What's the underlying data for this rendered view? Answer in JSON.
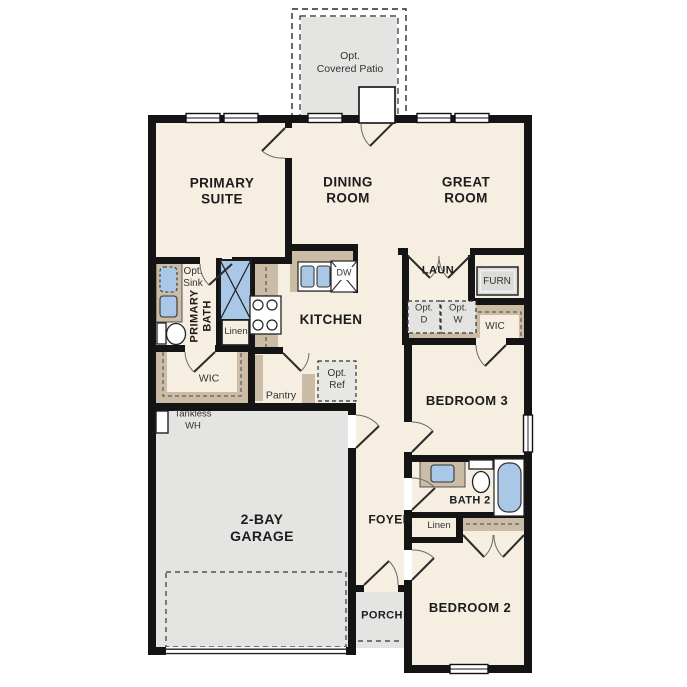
{
  "floorplan": {
    "rooms": {
      "opt_covered_patio": "Opt.\nCovered Patio",
      "primary_suite": "PRIMARY\nSUITE",
      "dining_room": "DINING\nROOM",
      "great_room": "GREAT\nROOM",
      "laundry": "LAUN",
      "kitchen": "KITCHEN",
      "primary_bath": "PRIMARY\nBATH",
      "primary_wic": "WIC",
      "bedroom3_wic": "WIC",
      "pantry": "Pantry",
      "bedroom3": "BEDROOM 3",
      "garage": "2-BAY\nGARAGE",
      "foyer": "FOYER",
      "bath2": "BATH 2",
      "porch": "PORCH",
      "bedroom2": "BEDROOM 2"
    },
    "fixtures": {
      "furnace": "FURN",
      "opt_dryer": "Opt.\nD",
      "opt_washer": "Opt.\nW",
      "opt_sink": "Opt.\nSink",
      "linen_primary": "Linen",
      "linen_bath2": "Linen",
      "dishwasher": "DW",
      "opt_ref": "Opt.\nRef",
      "tankless_wh": "Tankless\nWH"
    },
    "colors": {
      "floor": "#f5eee1",
      "optional_area": "#e4e4e2",
      "cabinet_tan": "#cbbda5",
      "fixture_blue": "#a9c8e8",
      "wall": "#141414"
    }
  }
}
